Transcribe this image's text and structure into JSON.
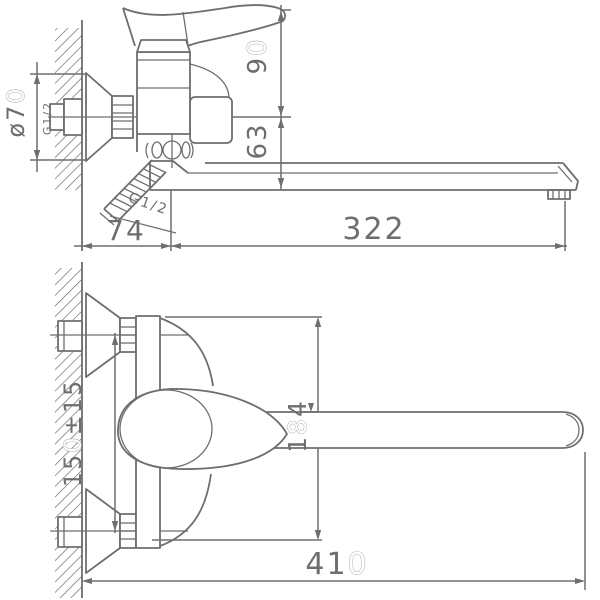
{
  "meta": {
    "type": "technical-drawing",
    "subject": "wall-mounted single-lever bath mixer with long swivel spout, side view above and front view below",
    "background": "#ffffff"
  },
  "colors": {
    "line": "#6e6e6e",
    "highlighted_digit_fill": "#ffffff"
  },
  "dimensions": {
    "side_view": {
      "flange_diameter": {
        "pre": "ø7",
        "hi": "0",
        "post": ""
      },
      "wall_thread": {
        "pre": "G1/2"
      },
      "handle_height_above_inlet": {
        "pre": "9",
        "hi": "0",
        "post": ""
      },
      "inlet_to_spout_drop": {
        "pre": "63"
      },
      "shower_hose_thread": {
        "pre": "G1/2"
      },
      "wall_to_spout_axis": {
        "pre": "74"
      },
      "spout_reach": {
        "pre": "322"
      }
    },
    "front_view": {
      "inlet_centres_spacing": {
        "pre": "15",
        "hi": "0",
        "post": "±15"
      },
      "body_height": {
        "pre": "1",
        "hi": "8",
        "post": "4"
      },
      "overall_length": {
        "pre": "41",
        "hi": "0",
        "post": ""
      }
    }
  }
}
